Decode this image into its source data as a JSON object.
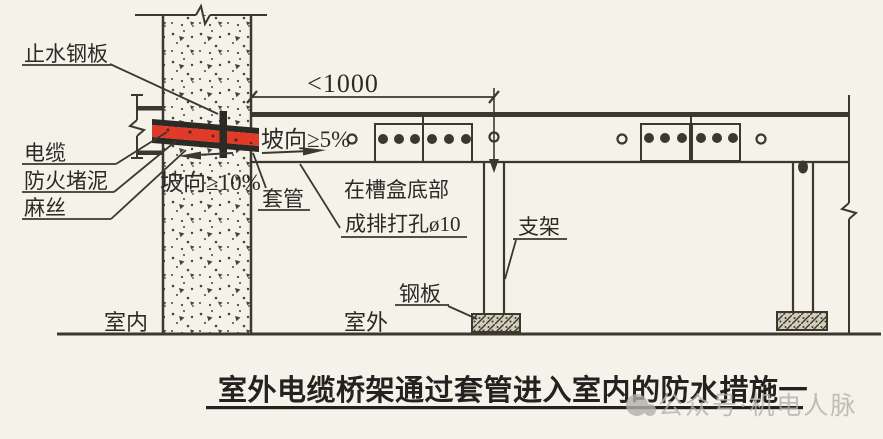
{
  "diagram": {
    "title_caption": "室外电缆桥架通过套管进入室内的防水措施一",
    "watermark": "公众号·机电人脉",
    "labels": {
      "water_stop_plate": "止水钢板",
      "cable": "电缆",
      "fireproof_mud": "防火堵泥",
      "hemp_fiber": "麻丝",
      "slope_wall": "坡向≥10%",
      "slope_tray": "坡向≥5%",
      "sleeve": "套管",
      "holes_note_line1": "在槽盒底部",
      "holes_note_line2": "成排打孔ø10",
      "bracket": "支架",
      "steel_plate": "钢板",
      "indoor": "室内",
      "outdoor": "室外"
    },
    "dimension": "<1000",
    "colors": {
      "background": "#f5f2ea",
      "line": "#3b382f",
      "cable_red": "#e23a28",
      "caption_text": "#24221e",
      "watermark_gray": "#b3b0aa"
    }
  }
}
